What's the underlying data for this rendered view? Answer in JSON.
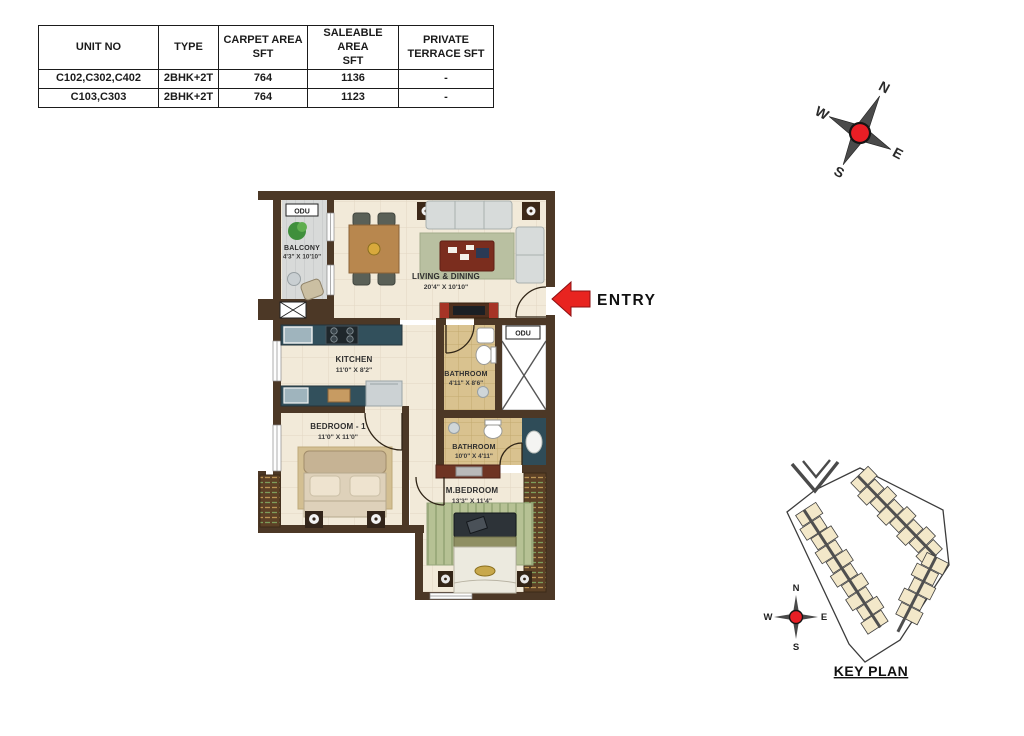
{
  "unit_table": {
    "headers": [
      "UNIT NO",
      "TYPE",
      "CARPET AREA\nSFT",
      "SALEABLE AREA\nSFT",
      "PRIVATE\nTERRACE  SFT"
    ],
    "rows": [
      [
        "C102,C302,C402",
        "2BHK+2T",
        "764",
        "1136",
        "-"
      ],
      [
        "C103,C303",
        "2BHK+2T",
        "764",
        "1123",
        "-"
      ]
    ]
  },
  "compass": {
    "n": "N",
    "e": "E",
    "s": "S",
    "w": "W"
  },
  "floorplan": {
    "entry_label": "ENTRY",
    "odu_labels": [
      "ODU",
      "ODU"
    ],
    "rooms": {
      "balcony": {
        "name": "BALCONY",
        "dims": "4'3\" X 10'10\""
      },
      "living": {
        "name": "LIVING & DINING",
        "dims": "20'4\" X 10'10\""
      },
      "kitchen": {
        "name": "KITCHEN",
        "dims": "11'0\" X 8'2\""
      },
      "bathroom1": {
        "name": "BATHROOM",
        "dims": "4'11\" X 8'6\""
      },
      "bathroom2": {
        "name": "BATHROOM",
        "dims": "10'0\" X 4'11\""
      },
      "bedroom1": {
        "name": "BEDROOM - 1",
        "dims": "11'0\" X 11'0\""
      },
      "mbedroom": {
        "name": "M.BEDROOM",
        "dims": "13'3\" X 11'4\""
      }
    }
  },
  "keyplan": {
    "title": "KEY PLAN",
    "compass": {
      "n": "N",
      "e": "E",
      "s": "S",
      "w": "W"
    }
  },
  "colors": {
    "wall": "#4c3826",
    "floor_cream": "#f2ead9",
    "bath_tan": "#d9c28f",
    "counter_teal": "#32505c",
    "entry_red": "#e82420",
    "compass_red": "#e81e25",
    "keyplan_highlight": "#f6a83a"
  }
}
